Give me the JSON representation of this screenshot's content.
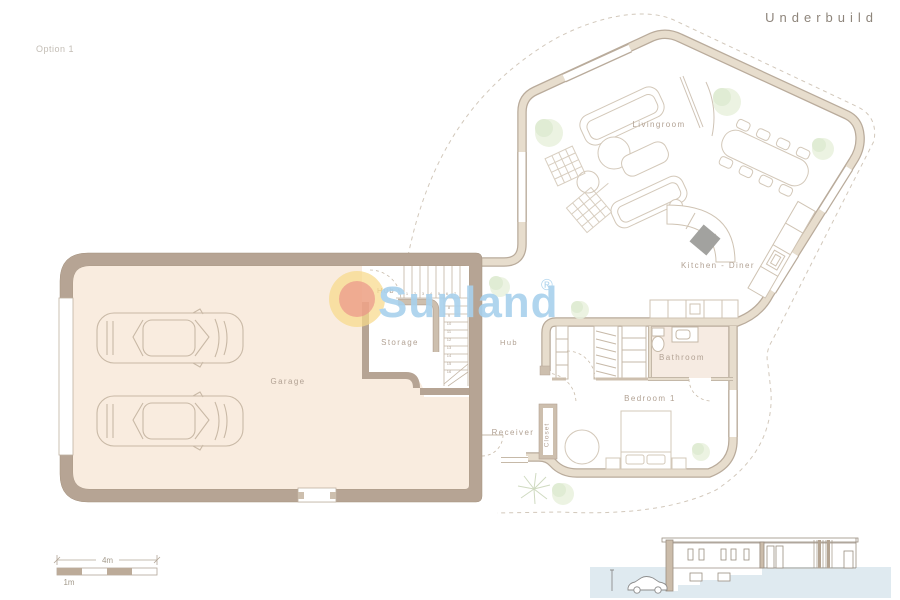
{
  "header": {
    "title": "Underbuild",
    "option_label": "Option 1"
  },
  "watermark": {
    "brand": "Sunland",
    "registered_mark": "®",
    "brand_color": "#a8d1ed",
    "logo_outer_color": "#f7d98b",
    "logo_inner_color": "#eea188"
  },
  "rooms": {
    "livingroom": "Livingroom",
    "kitchen_diner": "Kitchen - Diner",
    "hub_storage": "Hub",
    "storage": "Storage",
    "hub_main": "Hub",
    "bathroom": "Bathroom",
    "bedroom_1": "Bedroom 1",
    "receiver": "Receiver",
    "closet": "Closet",
    "garage": "Garage"
  },
  "scale_bar": {
    "major_label": "4m",
    "minor_label": "1m"
  },
  "stairs": {
    "step_numbers": [
      "1",
      "2",
      "3",
      "4",
      "5",
      "6",
      "7",
      "8",
      "9",
      "10",
      "11",
      "12",
      "13",
      "14",
      "15",
      "16"
    ]
  },
  "colors": {
    "thick_wall": "#b6a494",
    "thin_wall_fill": "#e7ddcd",
    "thin_wall_edge": "#b9ab9b",
    "garage_floor": "#f9ecdf",
    "bathroom_floor": "#f6ebe2",
    "label": "#b2a294",
    "ground_section": "#dfeaf0"
  }
}
